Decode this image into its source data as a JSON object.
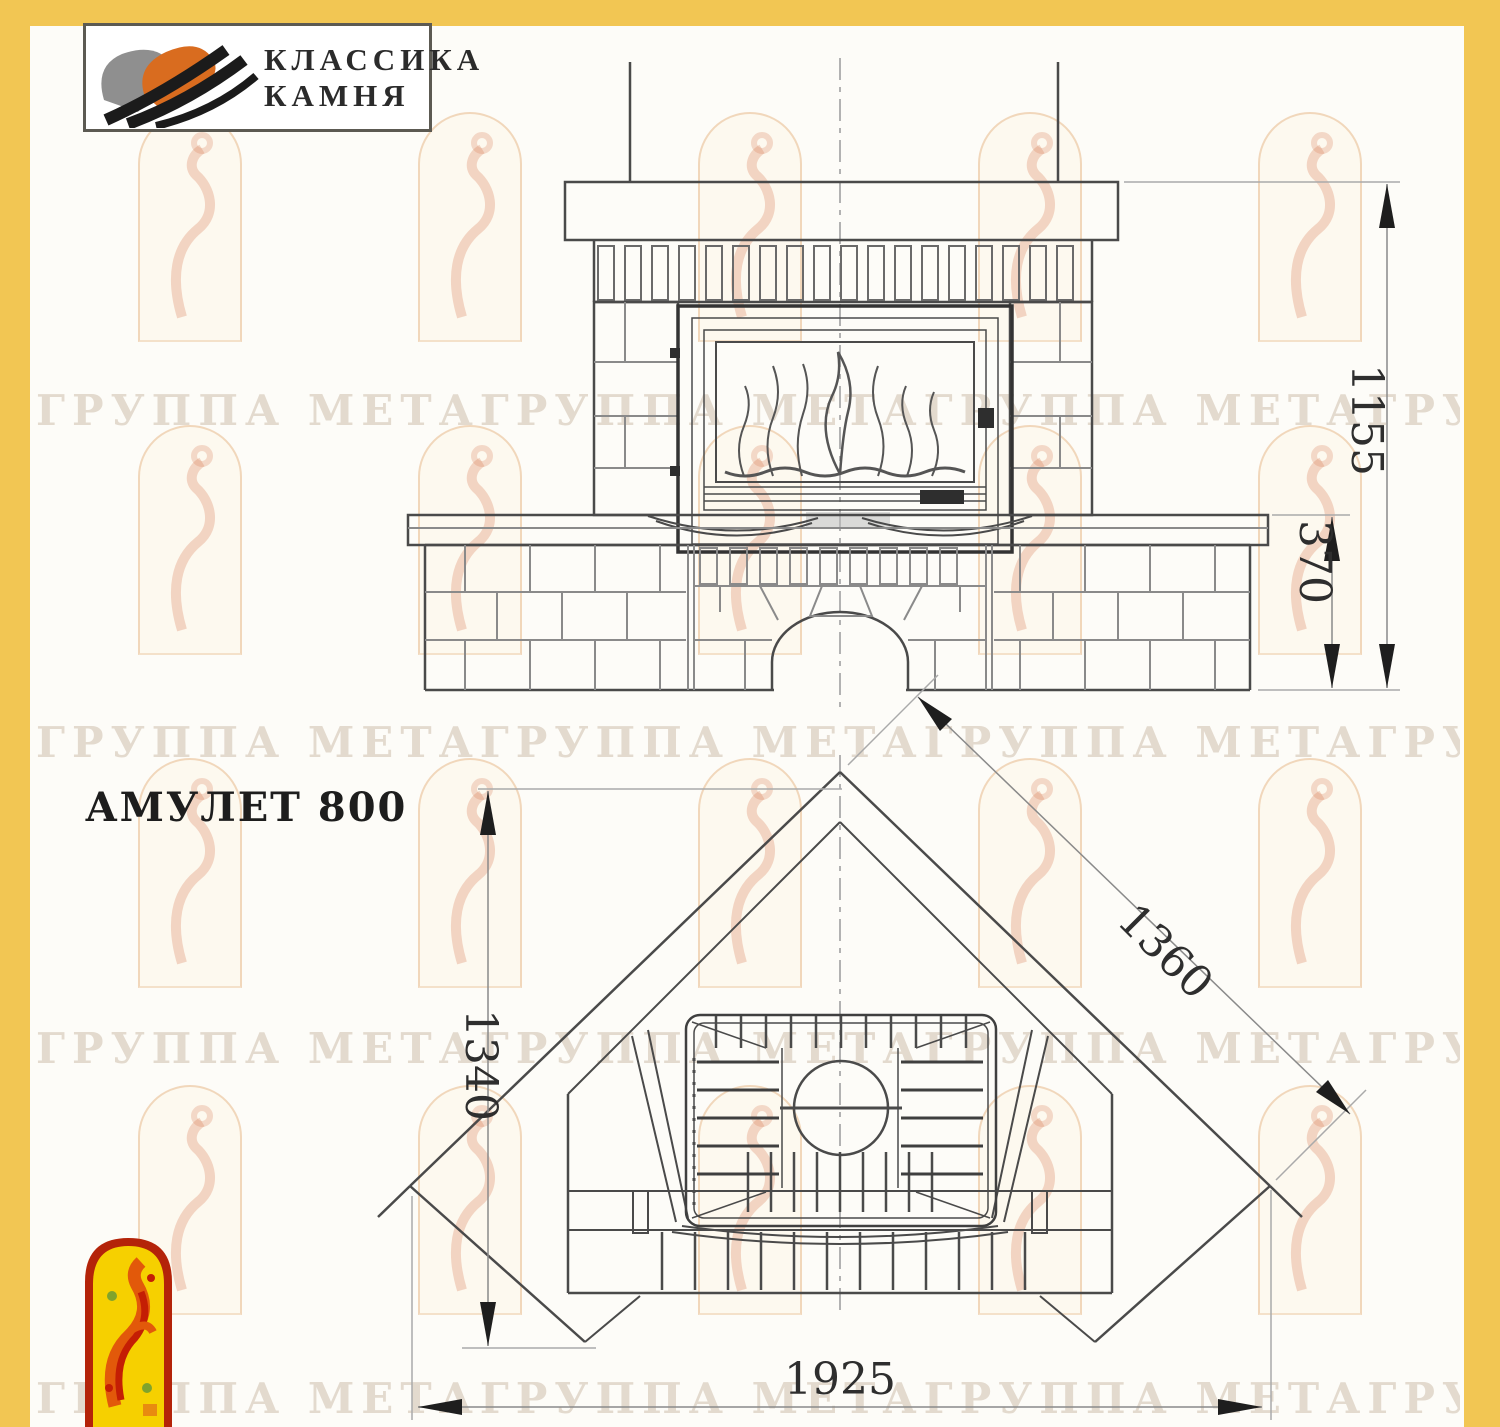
{
  "brand_logo": {
    "line1": "КЛАССИКА",
    "line2": "КАМНЯ"
  },
  "product_title": "АМУЛЕТ 800",
  "watermark_text": "ГРУППА МЕТАГРУППА МЕТАГРУППА МЕТАГРУППА МЕТА",
  "front_view": {
    "name": "front elevation of fireplace",
    "height_total_mm": "1155",
    "bench_height_mm": "370"
  },
  "plan_view": {
    "name": "corner installation plan",
    "depth_mm": "1340",
    "diagonal_side_mm": "1360",
    "width_mm": "1925"
  },
  "colors": {
    "frame_yellow": "#F2C653",
    "logo_orange": "#D96C1F",
    "logo_gray": "#8F8F8F",
    "emblem_red": "#B42309",
    "emblem_yellow": "#F6D000",
    "line_dark": "#4A4A4A",
    "line_gray": "#9A9A9A"
  }
}
